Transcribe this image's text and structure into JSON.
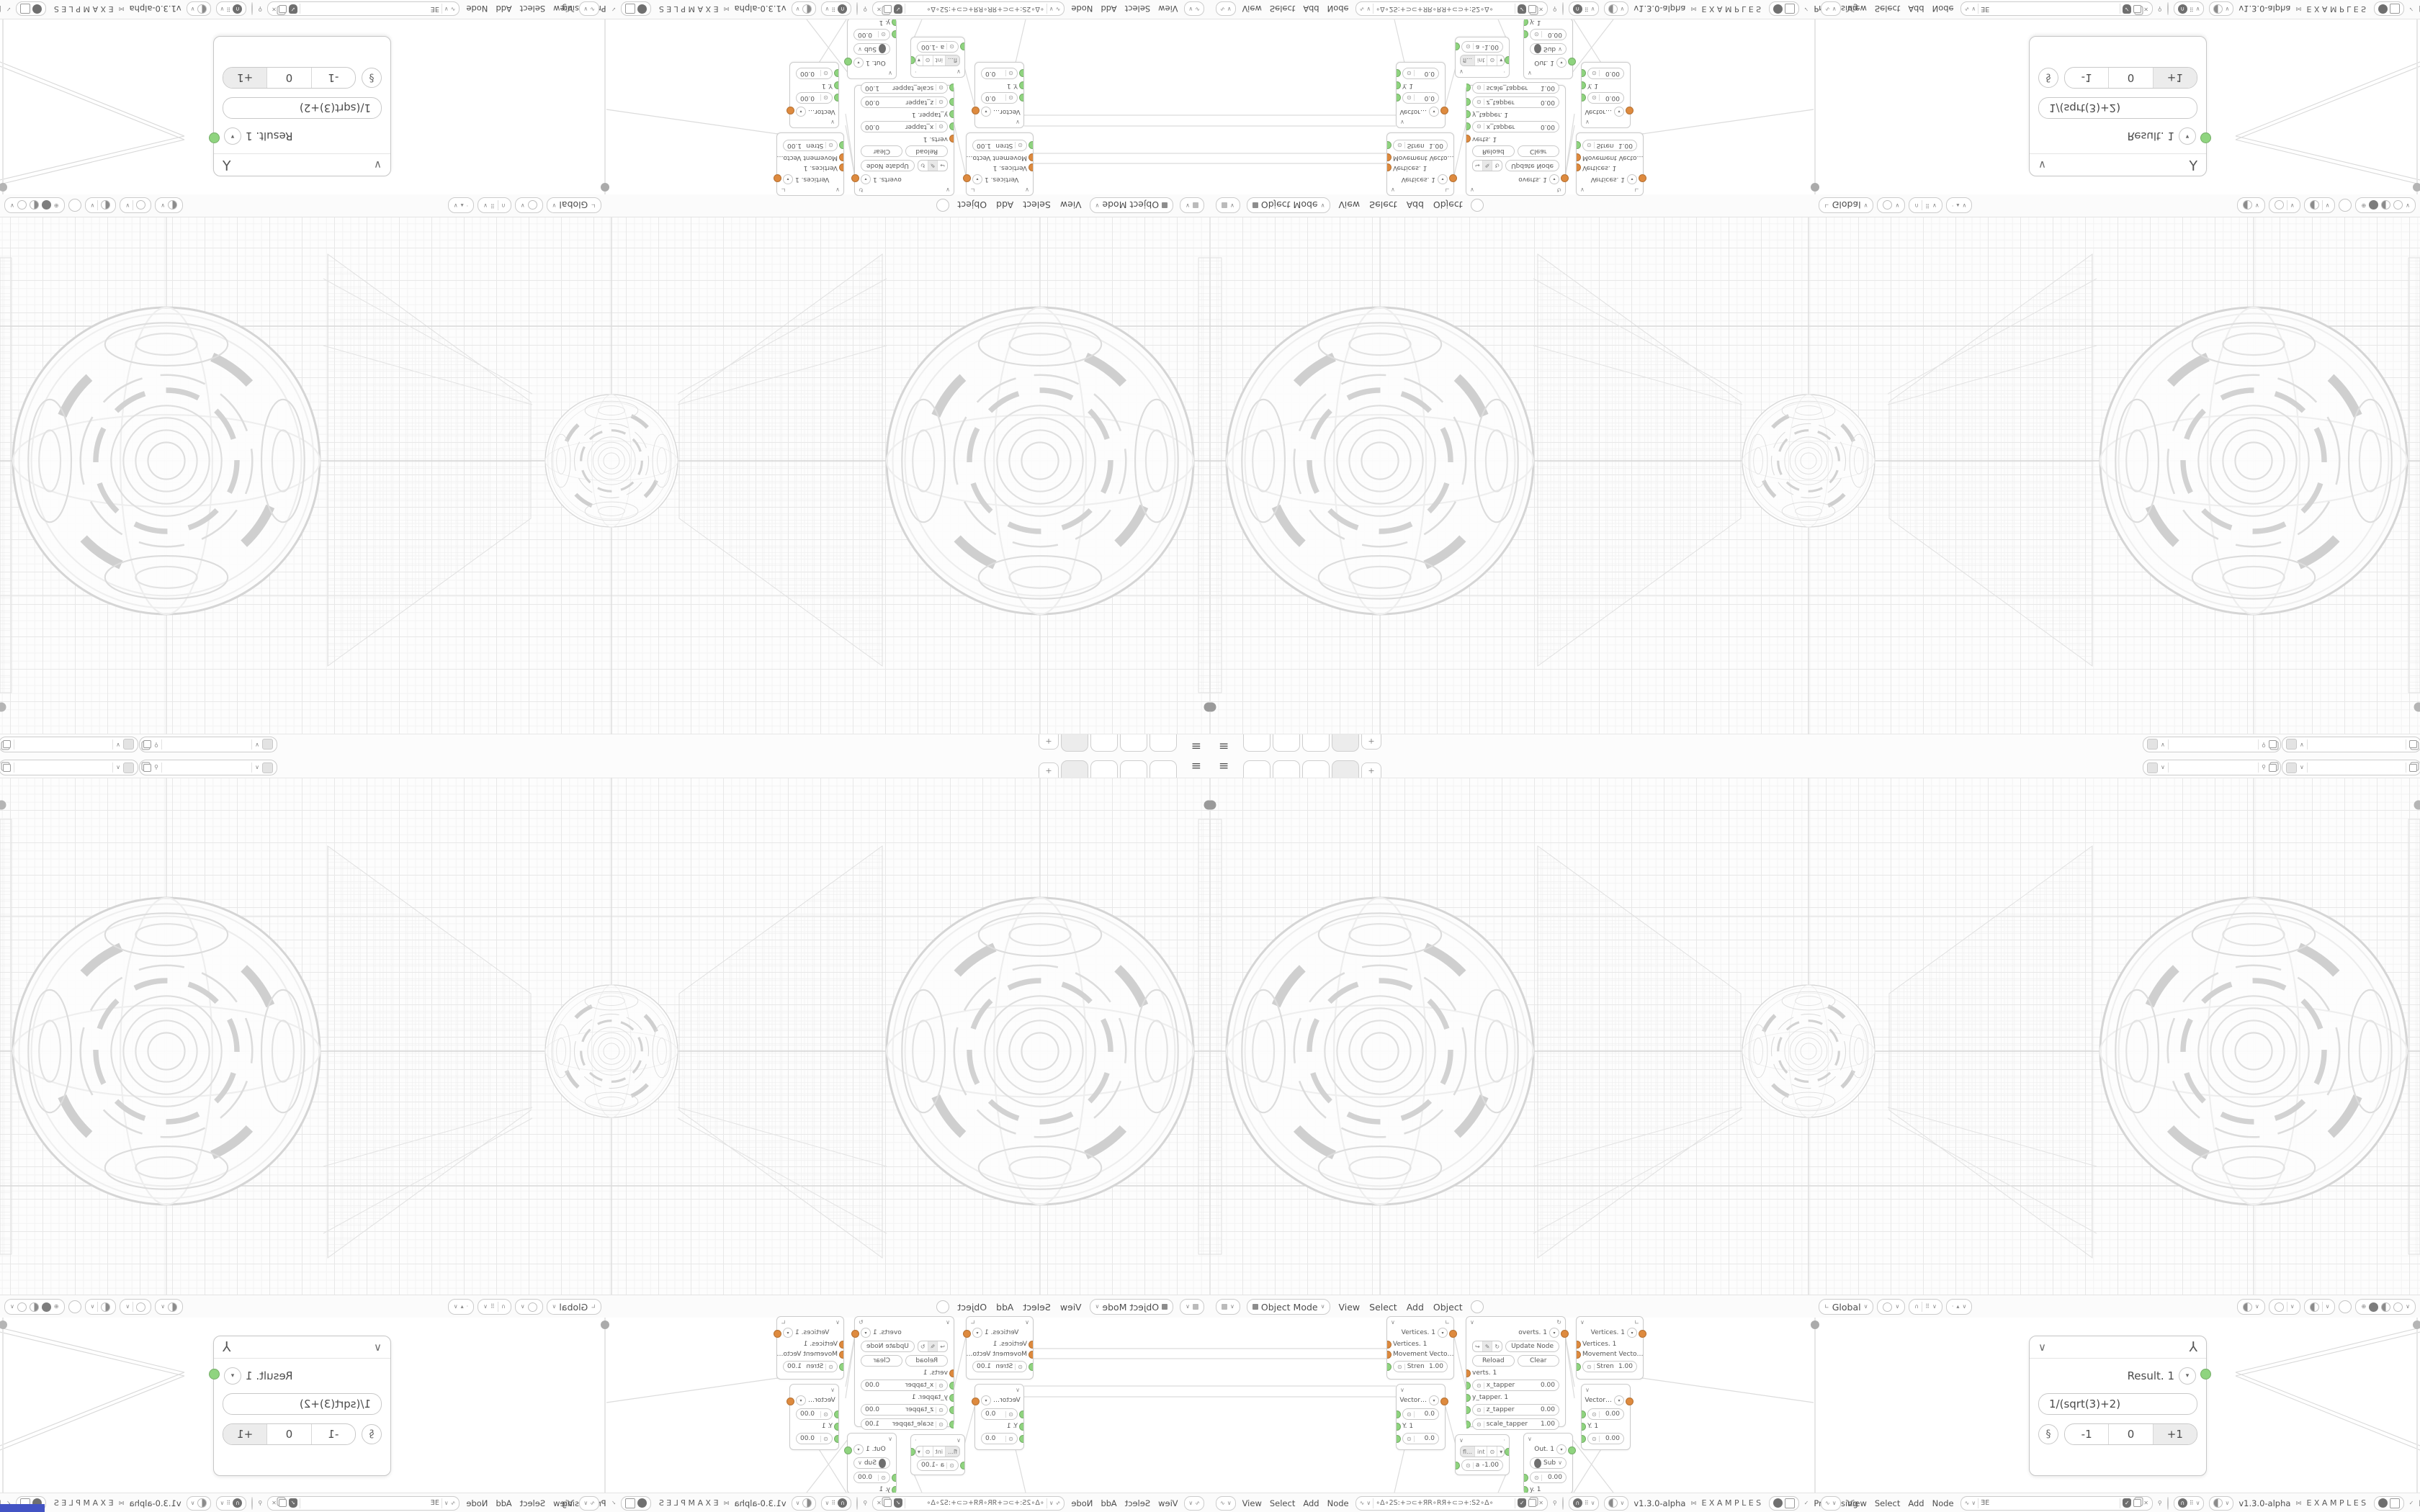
{
  "app": {
    "version": "v1.3.0-alpha",
    "brand": "EXAMPLES",
    "status": "Processing"
  },
  "icons": {
    "hamburger": "≡",
    "chevron": "∨",
    "dropdown": "▾",
    "plus": "+",
    "close": "✕",
    "check": "✓",
    "magnet": "∩",
    "snap_grid": "⠿",
    "bowtie": "⋈",
    "link": "§",
    "tool_gizmo": "⅄",
    "pin": "⚲",
    "redo": "↪",
    "refresh": "↻",
    "eyedropper": "✎",
    "knob": "⊙",
    "dot": "·",
    "corner": "∟",
    "cone": "▴",
    "globe": "⊕",
    "wave": "∿"
  },
  "topbar": {
    "add_tab": "+"
  },
  "viewport_header": {
    "mode": "Object Mode",
    "menus": {
      "0": "View",
      "1": "Select",
      "2": "Add",
      "3": "Object"
    },
    "orientation": "Global"
  },
  "bottom_bar": {
    "menus": {
      "0": "View",
      "1": "Select",
      "2": "Add",
      "3": "Node"
    },
    "tree_name_a": "∘Δ∘2S:+⊃⊂+ЯR∘RЯ+⊂⊃+:S2∘Δ∘",
    "tree_name_b": "ƎE"
  },
  "nodes": {
    "vertices": {
      "title": "Vertices. 1",
      "input1": "Vertices. 1",
      "input2": "Movement Vecto…",
      "stren_label": "Stren",
      "stren_value": "1.00"
    },
    "overts": {
      "title": "overts. 1",
      "update_btn": "Update Node",
      "reload_btn": "Reload",
      "clear_btn": "Clear",
      "output": "verts. 1",
      "f1_label": "x_tapper",
      "f1_value": "0.00",
      "f2_label": "y_tapper. 1",
      "f3_label": "z_tapper",
      "f3_value": "0.00",
      "f4_label": "scale_tapper",
      "f4_value": "1.00"
    },
    "vector_a": {
      "title": "Vector…",
      "v1": "0.0",
      "mid": "Y. 1",
      "v2": "0.0"
    },
    "vector_b": {
      "title": "Vector…",
      "v1": "0.00",
      "mid": "Y. 1",
      "v2": "0.00"
    },
    "math": {
      "t1": "fl…",
      "t2": "int",
      "field_label": "a",
      "field_value": "-1.00"
    },
    "out": {
      "title": "Out. 1",
      "op": "Sub",
      "value": "0.00",
      "input": "y. 1"
    }
  },
  "result_panel": {
    "title": "Result. 1",
    "expression": "1/(sqrt(3)+2)",
    "b1": "-1",
    "b2": "0",
    "b3": "+1"
  },
  "colors": {
    "socket_green": "#8fd47f",
    "socket_orange": "#de8a3e",
    "wire": "#dcdcdc",
    "accent_corner": "#4353c4"
  }
}
